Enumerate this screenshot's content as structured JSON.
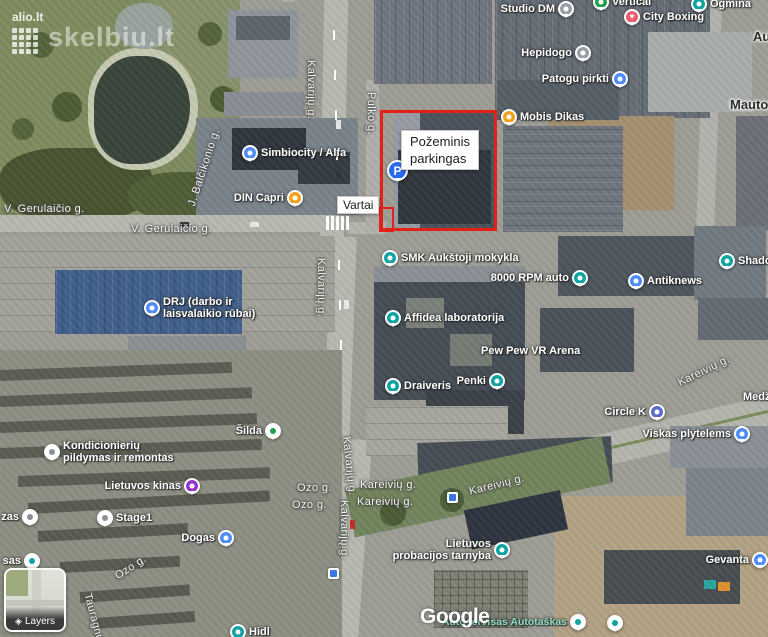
{
  "ui": {
    "layers_label": "Layers"
  },
  "watermarks": {
    "alio": "alio.lt",
    "skelbiu": "skelbiu.lt",
    "google": "Google"
  },
  "highlight": {
    "color": "#e32119",
    "label_line1": "Požeminis",
    "label_line2": "parkingas",
    "vartai_label": "Vartai"
  },
  "map": {
    "places": [
      {
        "id": "studio-dm",
        "name": "Studio DM",
        "x": 566,
        "y": 9,
        "pin": "gray",
        "icon": "dot-icon",
        "side": "left"
      },
      {
        "id": "vertical",
        "name": "Vertical",
        "x": 601,
        "y": 2,
        "pin": "green",
        "icon": "dot-icon",
        "side": "right"
      },
      {
        "id": "ogmina",
        "name": "Ogmina",
        "x": 699,
        "y": 4,
        "pin": "teal",
        "icon": "shopping-bag-icon",
        "side": "right"
      },
      {
        "id": "city-boxing",
        "name": "City Boxing",
        "x": 632,
        "y": 17,
        "pin": "heart",
        "icon": "heart-icon",
        "glyph": "♥",
        "side": "right"
      },
      {
        "id": "hepidogo",
        "name": "Hepidogo",
        "x": 583,
        "y": 53,
        "pin": "gray",
        "icon": "dot-icon",
        "side": "left"
      },
      {
        "id": "patogu-pirkti",
        "name": "Patogu pirkti",
        "x": 620,
        "y": 79,
        "pin": "blue",
        "icon": "shopping-bag-icon",
        "side": "left"
      },
      {
        "id": "mobis-dikas",
        "name": "Mobis Dikas",
        "x": 509,
        "y": 117,
        "pin": "orange",
        "icon": "restaurant-icon",
        "side": "right"
      },
      {
        "id": "mautor-partial",
        "name": "Mautor",
        "x": 730,
        "y": 105,
        "pin": "none",
        "side": "right",
        "cls": "label-dark"
      },
      {
        "id": "au-partial",
        "name": "Au",
        "x": 753,
        "y": 37,
        "pin": "none",
        "side": "right",
        "cls": "label-dark"
      },
      {
        "id": "top-partial",
        "name": "Te Ulyjos",
        "x": 252,
        "y": -7,
        "pin": "none",
        "side": "right",
        "cls": "label-dark"
      },
      {
        "id": "simbiocity-alfa",
        "name": "Simbiocity / Alfa",
        "x": 250,
        "y": 153,
        "pin": "blue",
        "icon": "shopping-bag-icon",
        "side": "right"
      },
      {
        "id": "din-capri",
        "name": "DIN Capri",
        "x": 295,
        "y": 198,
        "pin": "orange",
        "icon": "restaurant-icon",
        "side": "left"
      },
      {
        "id": "pozeminis-parkingas",
        "name": "",
        "x": 398,
        "y": 171,
        "pin": "parking",
        "icon": "parking-icon",
        "glyph": "P",
        "side": "right"
      },
      {
        "id": "drj",
        "name": "DRJ (darbo ir",
        "name2": "laisvalaikio rūbai)",
        "x": 152,
        "y": 308,
        "pin": "blue",
        "icon": "shopping-bag-icon",
        "side": "right"
      },
      {
        "id": "smk",
        "name": "SMK Aukštoji mokykla",
        "x": 390,
        "y": 258,
        "pin": "teal",
        "icon": "school-icon",
        "side": "right"
      },
      {
        "id": "rpm-8000",
        "name": "8000 RPM auto",
        "x": 580,
        "y": 278,
        "pin": "teal",
        "icon": "dot-icon",
        "side": "left"
      },
      {
        "id": "antiknews",
        "name": "Antiknews",
        "x": 636,
        "y": 281,
        "pin": "blue",
        "icon": "shopping-bag-icon",
        "side": "right"
      },
      {
        "id": "shado-partial",
        "name": "Shado",
        "x": 727,
        "y": 261,
        "pin": "teal",
        "icon": "dot-icon",
        "side": "right"
      },
      {
        "id": "affidea",
        "name": "Affidea laboratorija",
        "x": 393,
        "y": 318,
        "pin": "teal",
        "icon": "medical-icon",
        "side": "right"
      },
      {
        "id": "pew-pew",
        "name": "Pew Pew VR Arena",
        "x": 481,
        "y": 351,
        "pin": "none",
        "side": "right"
      },
      {
        "id": "draiveris",
        "name": "Draiveris",
        "x": 393,
        "y": 386,
        "pin": "teal",
        "icon": "dot-icon",
        "side": "right"
      },
      {
        "id": "penki",
        "name": "Penki",
        "x": 497,
        "y": 381,
        "pin": "teal",
        "icon": "dot-icon",
        "side": "left"
      },
      {
        "id": "circle-k",
        "name": "Circle K",
        "x": 657,
        "y": 412,
        "pin": "gas",
        "icon": "gas-station-icon",
        "side": "left"
      },
      {
        "id": "viskas-plytelems",
        "name": "Viskas plytelems",
        "x": 742,
        "y": 434,
        "pin": "blue",
        "icon": "shopping-bag-icon",
        "side": "left"
      },
      {
        "id": "medz-partial",
        "name": "Medž",
        "x": 743,
        "y": 397,
        "pin": "none",
        "side": "right"
      },
      {
        "id": "silda",
        "name": "Šilda",
        "x": 273,
        "y": 431,
        "pin": "white-green",
        "icon": "dot-icon",
        "side": "left"
      },
      {
        "id": "kondicionieriu",
        "name": "Kondicionierių",
        "name2": "pildymas ir remontas",
        "x": 52,
        "y": 452,
        "pin": "white-gray",
        "icon": "dot-icon",
        "side": "right"
      },
      {
        "id": "lietuvos-kinas",
        "name": "Lietuvos kinas",
        "x": 192,
        "y": 486,
        "pin": "purple",
        "icon": "movie-icon",
        "side": "left"
      },
      {
        "id": "stage1",
        "name": "Stage1",
        "x": 105,
        "y": 518,
        "pin": "white-gray",
        "icon": "dot-icon",
        "side": "right"
      },
      {
        "id": "zas-partial",
        "name": "zas",
        "x": 30,
        "y": 517,
        "pin": "white-gray",
        "icon": "dot-icon",
        "side": "left"
      },
      {
        "id": "dogas",
        "name": "Dogas",
        "x": 226,
        "y": 538,
        "pin": "blue",
        "icon": "shopping-bag-icon",
        "side": "left"
      },
      {
        "id": "sas-partial",
        "name": "sas",
        "x": 32,
        "y": 561,
        "pin": "white-teal",
        "icon": "dot-icon",
        "side": "left"
      },
      {
        "id": "probacijos",
        "name": "Lietuvos",
        "name2": "probacijos tarnyba",
        "x": 502,
        "y": 550,
        "pin": "teal",
        "icon": "dot-icon",
        "side": "left"
      },
      {
        "id": "gevanta",
        "name": "Gevanta",
        "x": 760,
        "y": 560,
        "pin": "blue",
        "icon": "shopping-bag-icon",
        "side": "left"
      },
      {
        "id": "autoservisas",
        "name": "Autoservisas Autotaškas",
        "x": 578,
        "y": 622,
        "pin": "white-teal",
        "icon": "dot-icon",
        "side": "left",
        "cls": "label-green"
      },
      {
        "id": "hidl-partial",
        "name": "Hidl",
        "x": 238,
        "y": 632,
        "pin": "teal",
        "icon": "dot-icon",
        "side": "right"
      },
      {
        "id": "unnamed-pin",
        "name": "",
        "x": 615,
        "y": 623,
        "pin": "white-teal",
        "icon": "dot-icon",
        "side": "right"
      }
    ],
    "street_labels": [
      {
        "text": "V. Gerulaičio g.",
        "x": 4,
        "y": 203,
        "rot": 0
      },
      {
        "text": "V. Gerulaičio g.",
        "x": 131,
        "y": 223,
        "rot": 0
      },
      {
        "text": "J. Balčikonio g.",
        "x": 186,
        "y": 204,
        "rot": -72
      },
      {
        "text": "Kalvarijų g.",
        "x": 317,
        "y": 60,
        "rot": 90
      },
      {
        "text": "Pulko g.",
        "x": 377,
        "y": 92,
        "rot": 90
      },
      {
        "text": "Kalvarijų g.",
        "x": 327,
        "y": 258,
        "rot": 90
      },
      {
        "text": "Kalvarijų g.",
        "x": 352,
        "y": 436,
        "rot": 84
      },
      {
        "text": "Kalvarijų g.",
        "x": 350,
        "y": 500,
        "rot": 90
      },
      {
        "text": "Ozo g.",
        "x": 297,
        "y": 482,
        "rot": 0
      },
      {
        "text": "Ozo g.",
        "x": 292,
        "y": 499,
        "rot": 0
      },
      {
        "text": "Kareivių g.",
        "x": 360,
        "y": 479,
        "rot": 0
      },
      {
        "text": "Kareivių g.",
        "x": 357,
        "y": 496,
        "rot": 0
      },
      {
        "text": "Kareivių g.",
        "x": 468,
        "y": 486,
        "rot": -14
      },
      {
        "text": "Kareivių g.",
        "x": 676,
        "y": 378,
        "rot": -26
      },
      {
        "text": "Ozo g.",
        "x": 113,
        "y": 572,
        "rot": -33
      },
      {
        "text": "Tauragnų g.",
        "x": 93,
        "y": 592,
        "rot": 75
      }
    ],
    "transit_icons": [
      {
        "x": 452,
        "y": 497
      },
      {
        "x": 333,
        "y": 573
      }
    ]
  }
}
